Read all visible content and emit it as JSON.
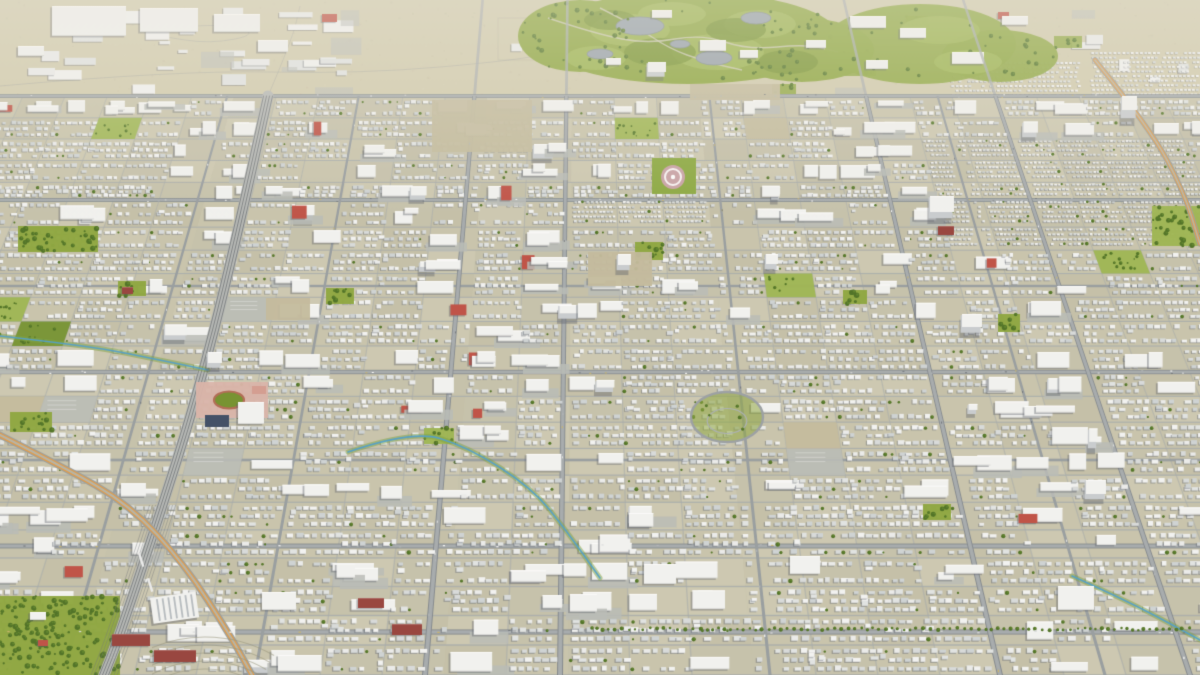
{
  "scene": {
    "description": "Low-poly 3D aerial render of a sprawling suburban city grid viewed at a tilt, no text or UI overlays",
    "canvas": {
      "width": 1200,
      "height": 675
    },
    "camera": {
      "vanishing_point_x": 580,
      "vanishing_point_y": -1140,
      "city_top_y": 96
    },
    "seed": 1337,
    "palette": {
      "ground": "#c8c4ab",
      "ground_alt": [
        "#c9c5ac",
        "#c4c0a8",
        "#cdc9b1",
        "#c6c2ab"
      ],
      "ground_far": "#d3ccae",
      "road_major_fill": "#a6abad",
      "road_major_casing": "#82888d",
      "road_medium": "#979da0",
      "road_minor": "#a6abac",
      "house_whites": [
        "#f4f5f4",
        "#eceeed",
        "#e2e5e4",
        "#d8dcdc",
        "#cfd4d5"
      ],
      "house_shadow": "rgba(96,102,112,0.45)",
      "box_white": "#f3f4f2",
      "box_side": "#c9cdd0",
      "box_shadow": "rgba(90,96,106,0.42)",
      "green_base": "#8ca63c",
      "green_light": "#9db64f",
      "green_dark": "#73912c",
      "tree_dark": "#4c7022",
      "tree_mid": "#5d8329",
      "pond": "#96a1ab",
      "path": "#d0cdb8",
      "rail_bed": "#b5b8b6",
      "rail_line": "#6f7477",
      "hwy_gray": "#9aa09f",
      "hwy_orange": "#e29a46",
      "hwy_inner": "#b7b5a6",
      "stream": "#4f9fc8",
      "stream_bank": "#7da23c",
      "brick_red": "#bf4f43",
      "maroon": "#96413a",
      "school_pink": "#dab4a9",
      "track_red": "#b06a52",
      "navy": "#3d4b64",
      "plaza_pink": "#c9a2a6",
      "lot_tan": "#c3ba9c",
      "lot_gray": "#b9bcb7",
      "haze_rgb": "238,235,224"
    },
    "roads": {
      "h_major_y": [
        96,
        200,
        372,
        546,
        632
      ],
      "h_medium_y": [
        286,
        460
      ],
      "v_major_bottom_x": [
        425,
        560,
        1000,
        1190
      ],
      "v_medium_bottom_x": [
        62,
        255,
        770,
        1105
      ],
      "minor_row_spacing": 30,
      "minor_col_spacing": 62
    },
    "railway": {
      "points": [
        [
          268,
          96
        ],
        [
          232,
          260
        ],
        [
          196,
          400
        ],
        [
          158,
          520
        ],
        [
          118,
          640
        ],
        [
          104,
          675
        ]
      ],
      "yard_from_y": 505
    },
    "highways": [
      {
        "points": [
          [
            -30,
            420
          ],
          [
            60,
            465
          ],
          [
            130,
            505
          ],
          [
            185,
            565
          ],
          [
            230,
            635
          ],
          [
            252,
            675
          ]
        ]
      },
      {
        "points": [
          [
            1095,
            60
          ],
          [
            1150,
            128
          ],
          [
            1184,
            192
          ],
          [
            1200,
            244
          ]
        ]
      }
    ],
    "streams": [
      {
        "points": [
          [
            0,
            336
          ],
          [
            90,
            346
          ],
          [
            160,
            360
          ],
          [
            208,
            370
          ]
        ]
      },
      {
        "points": [
          [
            348,
            452
          ],
          [
            412,
            430
          ],
          [
            468,
            447
          ],
          [
            532,
            488
          ],
          [
            566,
            530
          ],
          [
            600,
            578
          ]
        ]
      },
      {
        "points": [
          [
            1072,
            576
          ],
          [
            1130,
            602
          ],
          [
            1200,
            640
          ]
        ]
      }
    ],
    "golf": {
      "base": [
        [
          688,
          38,
          152,
          46
        ],
        [
          580,
          36,
          62,
          36
        ],
        [
          802,
          50,
          72,
          32
        ]
      ],
      "light": [
        [
          630,
          30,
          40,
          16
        ],
        [
          718,
          52,
          46,
          18
        ],
        [
          760,
          24,
          36,
          14
        ],
        [
          596,
          58,
          30,
          12
        ],
        [
          672,
          14,
          34,
          12
        ]
      ],
      "dark": [
        [
          660,
          52,
          36,
          14
        ],
        [
          736,
          30,
          30,
          12
        ],
        [
          610,
          20,
          26,
          10
        ],
        [
          788,
          62,
          30,
          12
        ]
      ],
      "ponds": [
        [
          640,
          26,
          24,
          9
        ],
        [
          714,
          58,
          18,
          7
        ],
        [
          600,
          54,
          13,
          5
        ],
        [
          756,
          18,
          15,
          6
        ],
        [
          680,
          44,
          10,
          4
        ]
      ],
      "paths": [
        [
          [
            548,
            18
          ],
          [
            596,
            34
          ],
          [
            648,
            44
          ],
          [
            702,
            34
          ],
          [
            748,
            50
          ],
          [
            806,
            44
          ],
          [
            838,
            52
          ]
        ],
        [
          [
            600,
            8
          ],
          [
            636,
            26
          ],
          [
            668,
            48
          ],
          [
            706,
            62
          ],
          [
            742,
            70
          ]
        ]
      ],
      "clubhouse": [
        [
          700,
          40,
          26,
          11
        ],
        [
          740,
          50,
          18,
          8
        ],
        [
          652,
          10,
          20,
          8
        ],
        [
          606,
          58,
          15,
          7
        ]
      ],
      "tree_count": 85
    },
    "campus": {
      "base": [
        [
          920,
          44,
          96,
          40
        ],
        [
          1000,
          56,
          58,
          26
        ]
      ],
      "light": [
        [
          940,
          30,
          40,
          14
        ],
        [
          968,
          62,
          34,
          12
        ]
      ],
      "slabs": [
        [
          850,
          16,
          36,
          12
        ],
        [
          900,
          28,
          26,
          10
        ],
        [
          952,
          52,
          32,
          12
        ],
        [
          1002,
          16,
          26,
          9
        ],
        [
          866,
          60,
          22,
          9
        ],
        [
          806,
          40,
          20,
          8
        ]
      ],
      "tree_count": 26
    },
    "industrial_strip": {
      "count": 46,
      "warehouses": [
        [
          52,
          6,
          74,
          30
        ],
        [
          140,
          8,
          58,
          24
        ],
        [
          214,
          14,
          46,
          18
        ],
        [
          258,
          40,
          30,
          12
        ],
        [
          18,
          46,
          26,
          10
        ]
      ],
      "red_boxes": [
        [
          322,
          14,
          15,
          8
        ],
        [
          998,
          12,
          11,
          7
        ]
      ],
      "green_patches": [
        [
          840,
          60,
          36,
          16
        ],
        [
          1054,
          36,
          28,
          12
        ],
        [
          906,
          16,
          22,
          10
        ],
        [
          772,
          84,
          24,
          10
        ]
      ],
      "dense_rows": [
        [
          1090,
          52,
          110,
          42
        ],
        [
          950,
          62,
          128,
          34
        ]
      ]
    },
    "dense_zones": [
      [
        938,
        148,
        262,
        112
      ],
      [
        556,
        192,
        140,
        46
      ]
    ],
    "commercial_zones": [
      [
        140,
        470,
        330,
        205
      ],
      [
        480,
        580,
        240,
        95
      ],
      [
        940,
        560,
        260,
        70
      ],
      [
        860,
        96,
        340,
        60
      ]
    ],
    "parks": [
      [
        18,
        226,
        80,
        26
      ],
      [
        118,
        281,
        28,
        15
      ],
      [
        10,
        412,
        42,
        20
      ],
      [
        326,
        288,
        28,
        16
      ],
      [
        635,
        242,
        28,
        18
      ],
      [
        998,
        314,
        22,
        18
      ],
      [
        843,
        290,
        24,
        14
      ],
      [
        923,
        504,
        28,
        16
      ],
      [
        1152,
        206,
        48,
        40
      ],
      [
        0,
        596,
        120,
        79
      ],
      [
        424,
        428,
        30,
        16
      ]
    ],
    "lots": [
      [
        432,
        100,
        100,
        52
      ],
      [
        588,
        252,
        64,
        34
      ],
      [
        266,
        298,
        44,
        22
      ],
      [
        690,
        84,
        90,
        16
      ]
    ],
    "tree_row": {
      "y": 629,
      "x0": 592,
      "x1": 1196
    },
    "orchard": {
      "cx": 205,
      "cy": 775,
      "r0": 82,
      "r1": 138,
      "step": 8,
      "clip": [
        152,
        626,
        152,
        49
      ]
    },
    "landmarks": {
      "towers": [
        [
          930,
          196,
          24,
          16,
          10
        ],
        [
          1122,
          96,
          15,
          14,
          14
        ],
        [
          618,
          254,
          13,
          11,
          8
        ],
        [
          766,
          254,
          12,
          10,
          8
        ],
        [
          962,
          314,
          20,
          13,
          9
        ],
        [
          1086,
          480,
          20,
          14,
          8
        ],
        [
          648,
          62,
          18,
          10,
          7
        ],
        [
          208,
          352,
          14,
          11,
          7
        ]
      ],
      "maroon": [
        [
          112,
          634,
          38,
          12
        ],
        [
          154,
          650,
          42,
          12
        ],
        [
          358,
          598,
          26,
          10
        ],
        [
          392,
          624,
          30,
          11
        ],
        [
          122,
          287,
          11,
          7
        ],
        [
          938,
          226,
          16,
          9
        ]
      ],
      "bigboxes": [
        [
          644,
          564,
          32,
          20
        ],
        [
          1058,
          586,
          36,
          24
        ],
        [
          262,
          592,
          34,
          18
        ],
        [
          790,
          556,
          30,
          18
        ]
      ],
      "school": {
        "rect": [
          196,
          382,
          72,
          36
        ],
        "track": [
          229,
          400,
          15,
          8.5
        ],
        "navy": [
          205,
          415,
          24,
          12
        ],
        "white": [
          238,
          402,
          26,
          22
        ],
        "court": [
          252,
          386,
          14,
          8
        ]
      },
      "grandstand": {
        "x": 150,
        "y": 598,
        "w": 46,
        "h": 26,
        "rot": -8,
        "stripes": 7
      },
      "oval": [
        727,
        417,
        36,
        25
      ],
      "plaza": {
        "rect": [
          652,
          158,
          44,
          36
        ],
        "cx": 673,
        "cy": 177,
        "r": 12
      }
    },
    "cars": {
      "h_count": 110,
      "v_count": 46,
      "colors": [
        "#ffffff",
        "#dbdddd",
        "#b0b5b8",
        "#70767b",
        "#c9b469"
      ]
    }
  }
}
